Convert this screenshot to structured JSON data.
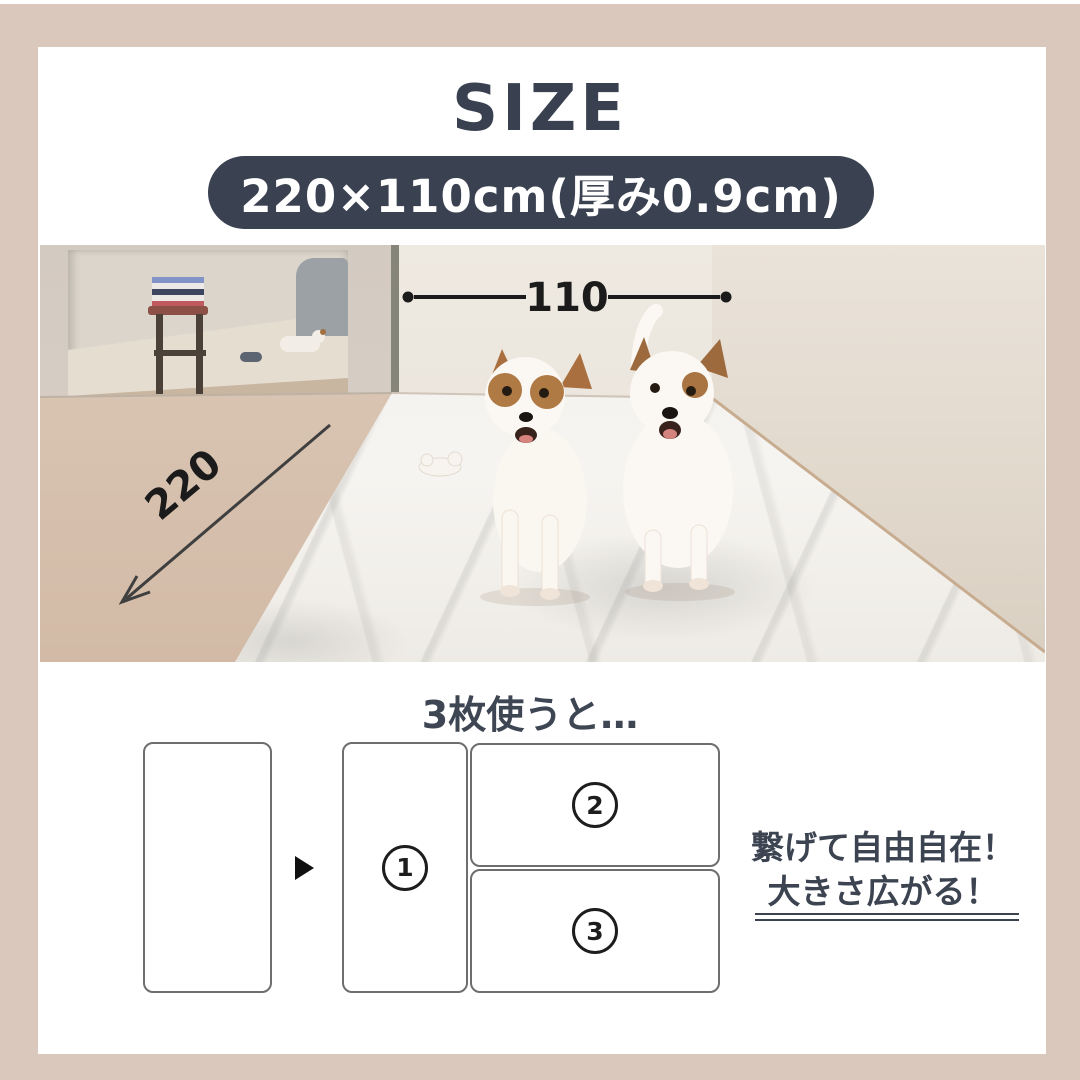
{
  "size_section": {
    "title": "SIZE",
    "badge": "220×110cm(厚み0.9cm)"
  },
  "photo": {
    "width_cm": "110",
    "length_cm": "220"
  },
  "combo_section": {
    "heading": "3枚使うと…",
    "mats": [
      {
        "num": "1"
      },
      {
        "num": "2"
      },
      {
        "num": "3"
      }
    ],
    "note": {
      "line1": "繋げて自由自在！",
      "line2": "大きさ広がる！"
    }
  },
  "colors": {
    "frame": "#d9c8bb",
    "badge_bg": "#3a4150",
    "title_text": "#394150",
    "note_text": "#3d4451",
    "dimension_lines": "#1b1b1b",
    "mat_marble_base": "#f3f1ed",
    "floor_beige": "#d6c0ad"
  }
}
